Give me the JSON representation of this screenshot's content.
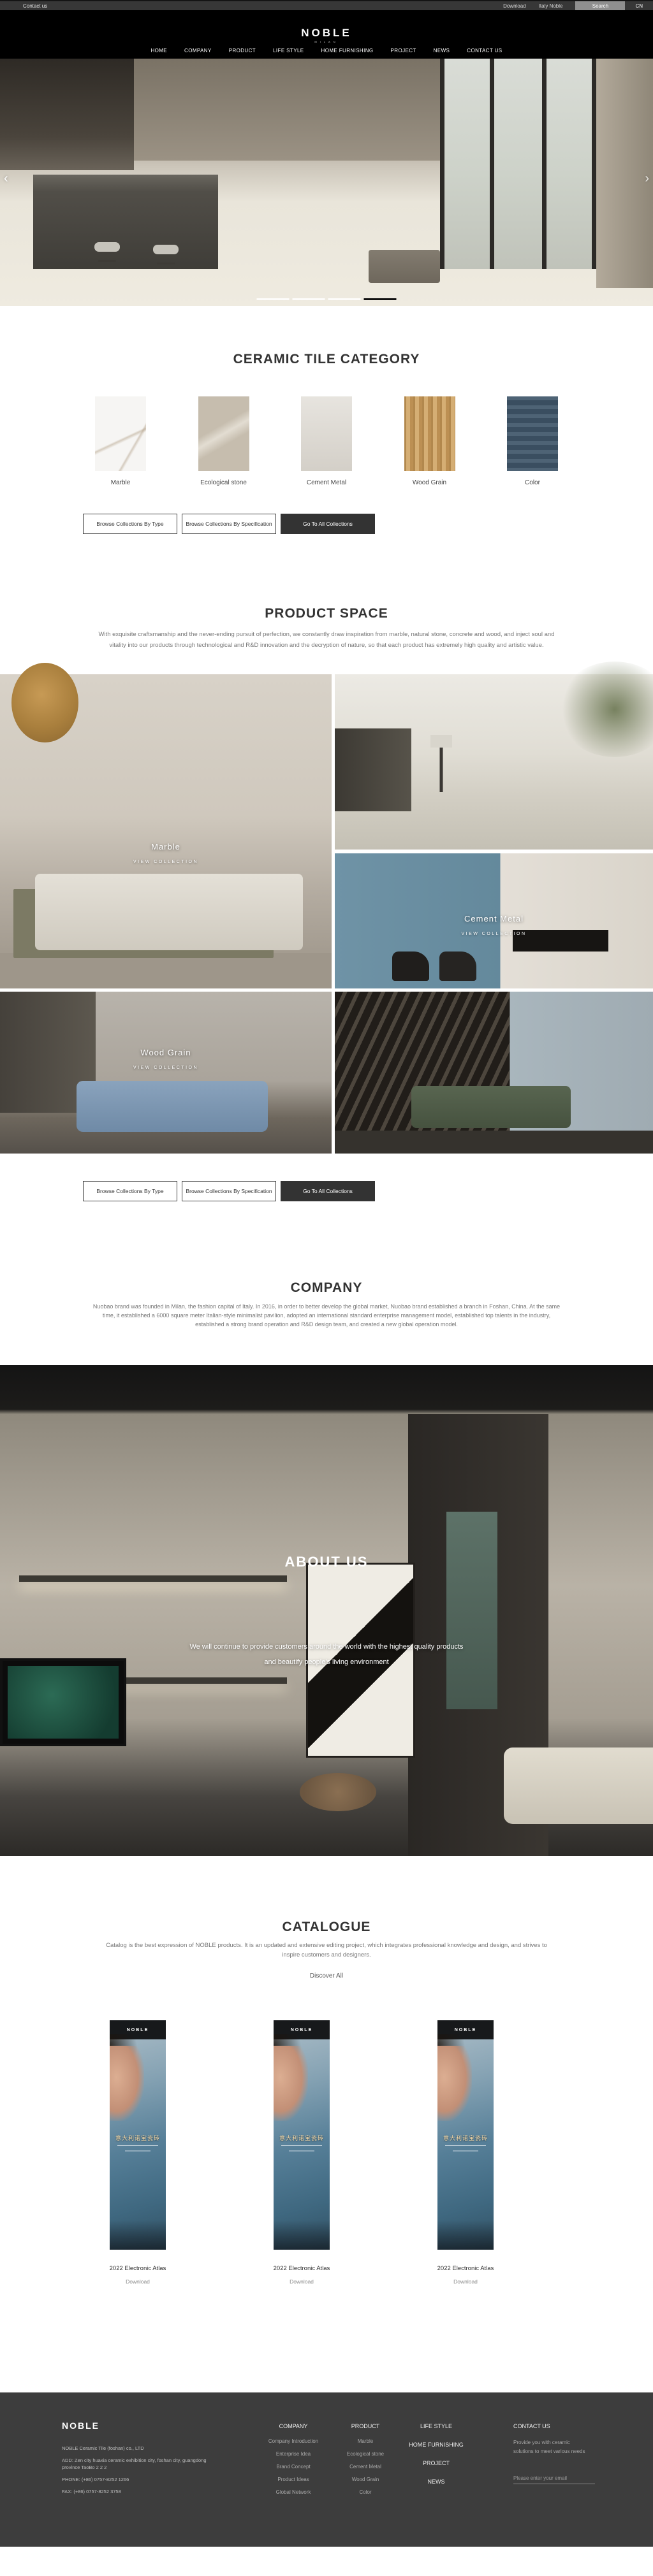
{
  "topbar": {
    "contact_us": "Contact us",
    "download": "Download",
    "italy_noble": "Italy Noble",
    "search": "Search",
    "language": "CN"
  },
  "header": {
    "logo": "NOBLE",
    "logo_subtitle": "MILAN",
    "nav": [
      "HOME",
      "COMPANY",
      "PRODUCT",
      "LIFE STYLE",
      "HOME FURNISHING",
      "PROJECT",
      "NEWS",
      "CONTACT US"
    ]
  },
  "hero": {
    "prev_icon": "‹",
    "next_icon": "›",
    "slide_count": 4,
    "active_slide": 4,
    "active_indicator_color": "#101010",
    "indicator_color": "#ffffff"
  },
  "category": {
    "title": "CERAMIC TILE CATEGORY",
    "items": [
      {
        "label": "Marble",
        "color": "#f6f5f3"
      },
      {
        "label": "Ecological stone",
        "color": "#c6bdae"
      },
      {
        "label": "Cement Metal",
        "color": "#dfdbd4"
      },
      {
        "label": "Wood Grain",
        "color": "#c99d5f"
      },
      {
        "label": "Color",
        "color": "#41576b"
      }
    ]
  },
  "collection_buttons": {
    "by_type": "Browse Collections By Type",
    "by_spec": "Browse Collections By Specification",
    "all": "Go To All Collections",
    "dark_button_color": "#333333"
  },
  "product_space": {
    "title": "PRODUCT SPACE",
    "paragraph": "With exquisite craftsmanship and the never-ending pursuit of perfection, we constantly draw inspiration from marble, natural stone, concrete and wood, and inject soul and vitality into our products through technological and R&D innovation and the decryption of nature, so that each product has extremely high quality and artistic value.",
    "tiles": [
      {
        "label": "Marble",
        "sub": "VIEW COLLECTION"
      },
      {
        "label": "Cement Metal",
        "sub": "VIEW COLLECTION"
      },
      {
        "label": "Wood Grain",
        "sub": "VIEW COLLECTION"
      }
    ]
  },
  "company": {
    "title": "COMPANY",
    "paragraph": "Nuobao brand was founded in Milan, the fashion capital of Italy. In 2016, in order to better develop the global market, Nuobao brand established a branch in Foshan, China. At the same time, it established a 6000 square meter Italian-style minimalist pavilion, adopted an international standard enterprise management model, established top talents in the industry, established a strong brand operation and R&D design team, and created a new global operation model."
  },
  "about": {
    "title": "ABOUT US",
    "line1": "We will continue to provide customers around the world with the highest quality products",
    "line2": "and beautify people's living environment"
  },
  "catalogue": {
    "title": "CATALOGUE",
    "paragraph": "Catalog is the best expression of NOBLE products. It is an updated and extensive editing project, which integrates professional knowledge and design, and strives to inspire customers and designers.",
    "discover": "Discover All",
    "poster": {
      "brand": "NOBLE",
      "title_cn": "意大利诺宝瓷砖"
    },
    "items": [
      {
        "name": "2022 Electronic Atlas",
        "download": "Download"
      },
      {
        "name": "2022 Electronic Atlas",
        "download": "Download"
      },
      {
        "name": "2022 Electronic Atlas",
        "download": "Download"
      }
    ]
  },
  "footer": {
    "logo": "NOBLE",
    "company_name": "NOBLE Ceramic Tile (foshan) co., LTD",
    "address": "ADD:  Zen city huaxia ceramic exhibition city, foshan city, guangdong province TaoBo 2 2 2",
    "phone": "PHONE:   (+86)  0757-8252 1266",
    "fax": "FAX:   (+86)  0757-8252 3758",
    "columns": [
      {
        "title": "COMPANY",
        "links": [
          "Company Introduction",
          "Enterprise Idea",
          "Brand Concept",
          "Product Ideas",
          "Global Network"
        ]
      },
      {
        "title": "PRODUCT",
        "links": [
          "Marble",
          "Ecological stone",
          "Cement Metal",
          "Wood Grain",
          "Color"
        ]
      }
    ],
    "menu_links": [
      "LIFE STYLE",
      "HOME FURNISHING",
      "PROJECT",
      "NEWS"
    ],
    "contact": {
      "title": "CONTACT US",
      "text": "Provide you with ceramic solutions to meet various needs",
      "email_placeholder": "Please enter your email"
    },
    "background_color": "#3d3d3d"
  }
}
